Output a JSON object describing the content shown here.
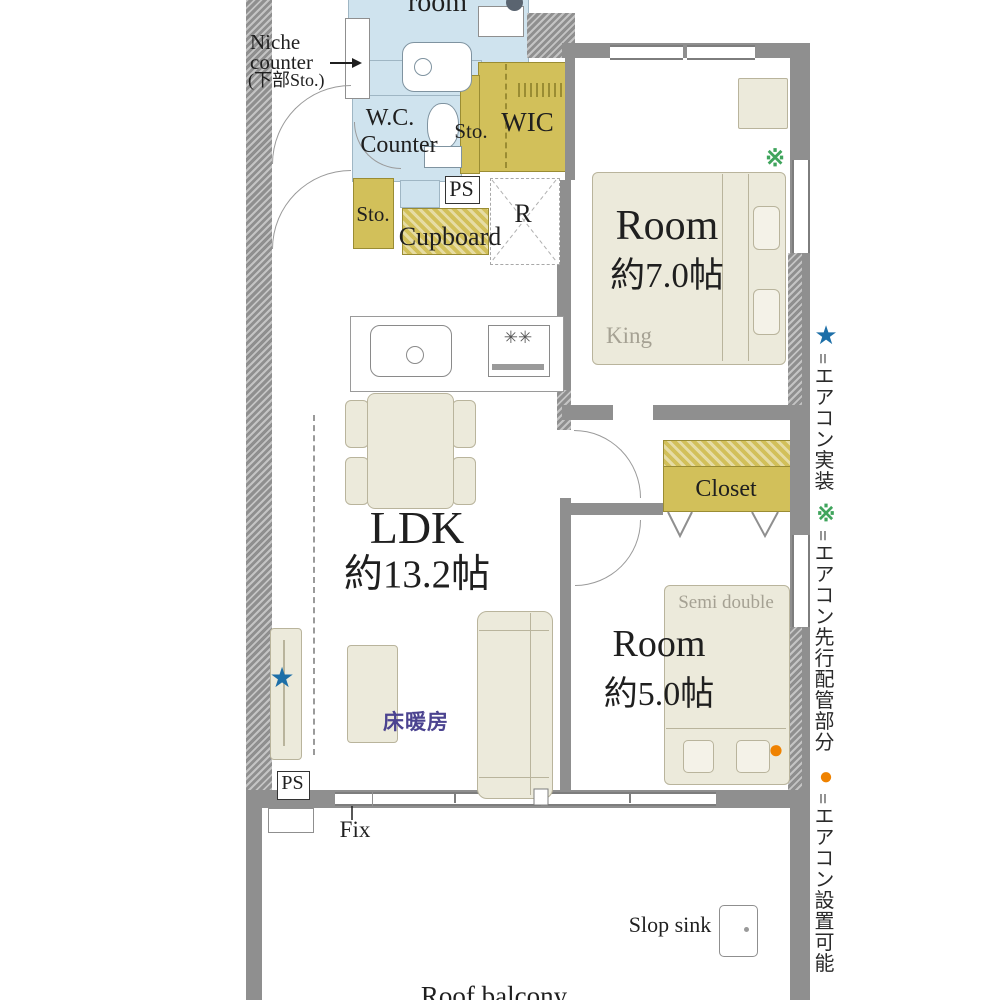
{
  "floorplan": {
    "labels": {
      "partial_room": "room",
      "niche_line1": "Niche",
      "niche_line2": "counter",
      "niche_line3": "(下部Sto.)",
      "wc_line1": "W.C.",
      "wc_line2": "Counter",
      "sto_a": "Sto.",
      "wic": "WIC",
      "ps_top": "PS",
      "sto_b": "Sto.",
      "cupboard": "Cupboard",
      "fridge": "R",
      "closet": "Closet",
      "fix": "Fix",
      "ps_bottom": "PS",
      "slop_sink": "Slop sink",
      "roof_balcony": "Roof balcony"
    },
    "rooms": {
      "room7": {
        "name": "Room",
        "size": "約7.0帖",
        "bed": "King"
      },
      "ldk": {
        "name": "LDK",
        "size": "約13.2帖",
        "floor_heating": "床暖房"
      },
      "room5": {
        "name": "Room",
        "size": "約5.0帖",
        "bed": "Semi double"
      }
    },
    "markers": {
      "star": "★",
      "asterisk": "※",
      "circle": "●"
    },
    "colors": {
      "storage": "#d2c05a",
      "wet_area": "#cfe3ee",
      "furniture": "#eceadb",
      "wall": "#8f8f8f",
      "floor_heating_text": "#4b4390",
      "star_blue": "#1d6fa8",
      "asterisk_green": "#3fa45c",
      "circle_orange": "#ef8200"
    }
  },
  "legend": {
    "items": [
      {
        "symbol": "★",
        "text": "=エアコン実装"
      },
      {
        "symbol": "※",
        "text": "=エアコン先行配管部分"
      },
      {
        "symbol": "●",
        "text": "=エアコン設置可能"
      }
    ]
  }
}
